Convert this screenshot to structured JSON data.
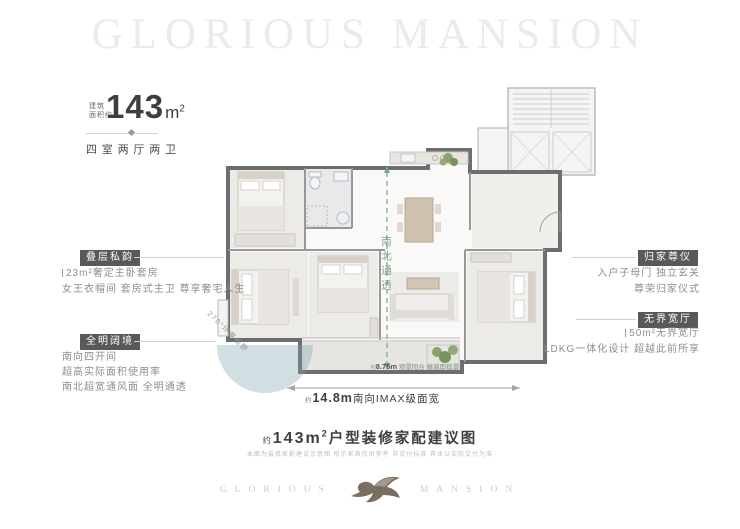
{
  "watermark": {
    "text": "GLORIOUS MANSION"
  },
  "unit_info": {
    "area_label_line1": "建筑",
    "area_label_line2": "面积约",
    "area_value": "143",
    "area_unit": "m",
    "area_unit_exp": "2",
    "layout": "四室两厅两卫"
  },
  "annotations": {
    "left": [
      {
        "title": "叠层私韵",
        "lines": [
          "23m²奢定主卧套房",
          "女王衣帽间 套房式主卫 尊享奢宅人生"
        ]
      },
      {
        "title": "全明阔境",
        "lines": [
          "南向四开间",
          "超高实际面积使用率",
          "南北超宽通风面 全明通透"
        ]
      }
    ],
    "right": [
      {
        "title": "归家尊仪",
        "lines": [
          "入户子母门 独立玄关",
          "尊荣归家仪式"
        ]
      },
      {
        "title": "无界宽厅",
        "lines": [
          "50m²无界宽厅",
          "LDKG一体化设计 超越此前所享"
        ]
      }
    ]
  },
  "plan_labels": {
    "flow": "南北通透",
    "panorama": "270°环幕视野",
    "balcony_prefix": "约",
    "balcony_value": "8.75m",
    "balcony_text": "观景阳台 推窗即揽景",
    "width_prefix": "约",
    "width_value": "14.8m",
    "width_text": "南向IMAX级面宽"
  },
  "caption": {
    "prefix": "约",
    "area": "143m",
    "area_exp": "2",
    "title": "户型装修家配建议图",
    "disclaimer": "本图为装修家配建议示意图 所示家具仅供参考 非交付标准 具体以实际交付为准"
  },
  "footer": {
    "brand_left": "GLORIOUS",
    "brand_right": "MANSION"
  },
  "colors": {
    "label_box": "#58595b",
    "flow_green": "#7ca38b",
    "view_teal": "#7ca3ac",
    "text_dark": "#3d3e41",
    "text_gray": "#8e8e8e"
  }
}
